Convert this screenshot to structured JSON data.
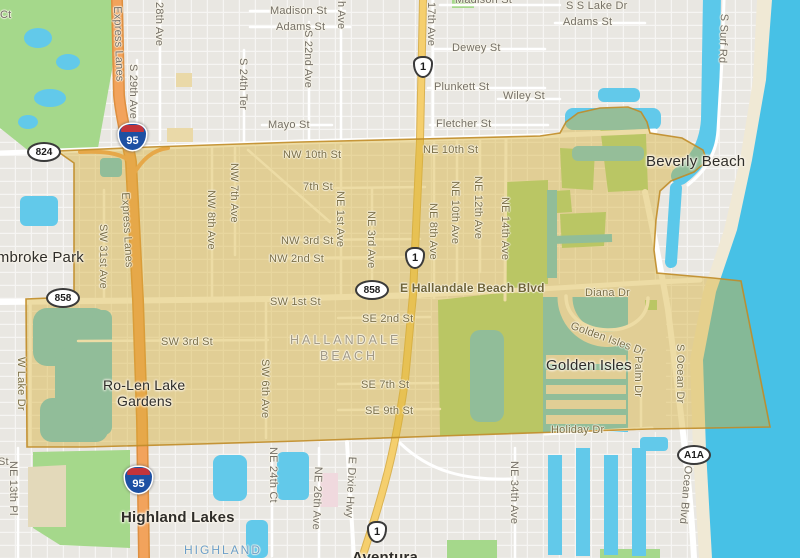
{
  "title": "Map of Hallandale Beach, FL with highlighted city-boundary overlay",
  "colors": {
    "land": "#e9e7e2",
    "road": "#ffffff",
    "park_green": "#a5d88b",
    "water_blue": "#53c6e8",
    "ocean": "#47c1e6",
    "beach_sand": "#f0e9d5",
    "highway_orange": "#f2a35c",
    "us1_yellow": "#f5cf6e",
    "overlay_fill": "#d6b031",
    "overlay_border": "#c08c28",
    "building_cream": "#ead9a8",
    "building_pink": "#f0d9de",
    "khaki_field": "#e3d9ba"
  },
  "shields": {
    "sr824": "824",
    "sr858": "858",
    "us1": "1",
    "i95": "95",
    "a1a": "A1A"
  },
  "places": {
    "pembroke_park": "Pembroke Park",
    "hallandale_line1": "HALLANDALE",
    "hallandale_line2": "BEACH",
    "beverly_beach": "Beverly Beach",
    "ro_len_line1": "Ro-Len Lake",
    "ro_len_line2": "Gardens",
    "golden_isles": "Golden Isles",
    "highland_lakes": "Highland Lakes",
    "highland": "HIGHLAND",
    "aventura": "Aventura"
  },
  "streets": {
    "ct": "Ct",
    "st_partial": "St",
    "madison_w": "Madison St",
    "adams_w": "Adams St",
    "mayo": "Mayo St",
    "s_22nd_ave": "S 22nd Ave",
    "s_29th_ave": "S 29th Ave",
    "ave_28th": "28th Ave",
    "s_24th_ter": "S 24th Ter",
    "h_ave": "h Ave",
    "ave_17th": "17th Ave",
    "madison_e": "Madison St",
    "s_s_lake_dr": "S S Lake Dr",
    "adams_e": "Adams St",
    "dewey": "Dewey St",
    "plunkett": "Plunkett St",
    "wiley": "Wiley St",
    "fletcher": "Fletcher St",
    "s_surf_rd": "S Surf Rd",
    "express_lanes_n": "Express Lanes",
    "express_lanes_s": "Express Lanes",
    "nw_10th": "NW 10th St",
    "ne_10th": "NE 10th St",
    "st_7th": "7th St",
    "nw_3rd": "NW 3rd St",
    "nw_2nd": "NW 2nd St",
    "sw_31st_ave": "SW 31st Ave",
    "nw_8th_ave": "NW 8th Ave",
    "nw_7th_ave": "NW 7th Ave",
    "ne_1st_ave": "NE 1st Ave",
    "ne_3rd_ave": "NE 3rd Ave",
    "ne_8th_ave": "NE 8th Ave",
    "ne_10th_ave": "NE 10th Ave",
    "ne_12th_ave": "NE 12th Ave",
    "ne_14th_ave": "NE 14th Ave",
    "hallandale_blvd": "E Hallandale Beach Blvd",
    "sw_1st": "SW 1st St",
    "se_2nd": "SE 2nd St",
    "sw_3rd": "SW 3rd St",
    "se_7th": "SE 7th St",
    "se_9th": "SE 9th St",
    "diana_dr": "Diana Dr",
    "golden_isles_dr": "Golden Isles Dr",
    "palm_dr": "Palm Dr",
    "s_ocean_dr": "S Ocean Dr",
    "holiday_dr": "Holiday Dr",
    "w_lake_dr": "W Lake Dr",
    "sw_6th_ave": "SW 6th Ave",
    "ne_13th_pl": "NE 13th Pl",
    "ne_24th_ct": "NE 24th Ct",
    "ne_26th_ave": "NE 26th Ave",
    "e_dixie_hwy": "E Dixie Hwy",
    "ne_34th_ave": "NE 34th Ave",
    "ocean_blvd": "Ocean Blvd"
  }
}
